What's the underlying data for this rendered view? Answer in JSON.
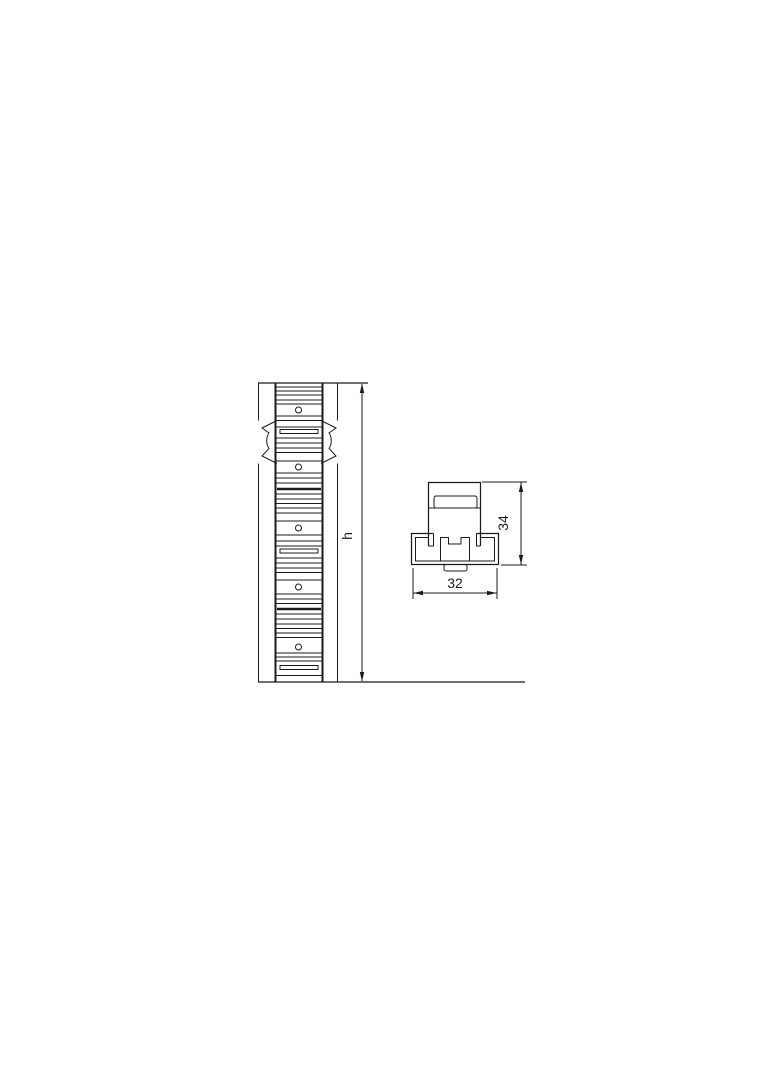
{
  "page": {
    "background_color": "#ffffff",
    "line_color": "#1b1b1b",
    "content": "technical line drawing, two orthographic views of a slotted mounting profile strip"
  },
  "front_view": {
    "name": "front-view-profile-strip",
    "hole_count": 5,
    "dimension_h": {
      "label": "h"
    }
  },
  "section_view": {
    "name": "cross-section-profile",
    "dimension_height": {
      "label": "34",
      "value_mm": 34
    },
    "dimension_width": {
      "label": "32",
      "value_mm": 32
    }
  }
}
